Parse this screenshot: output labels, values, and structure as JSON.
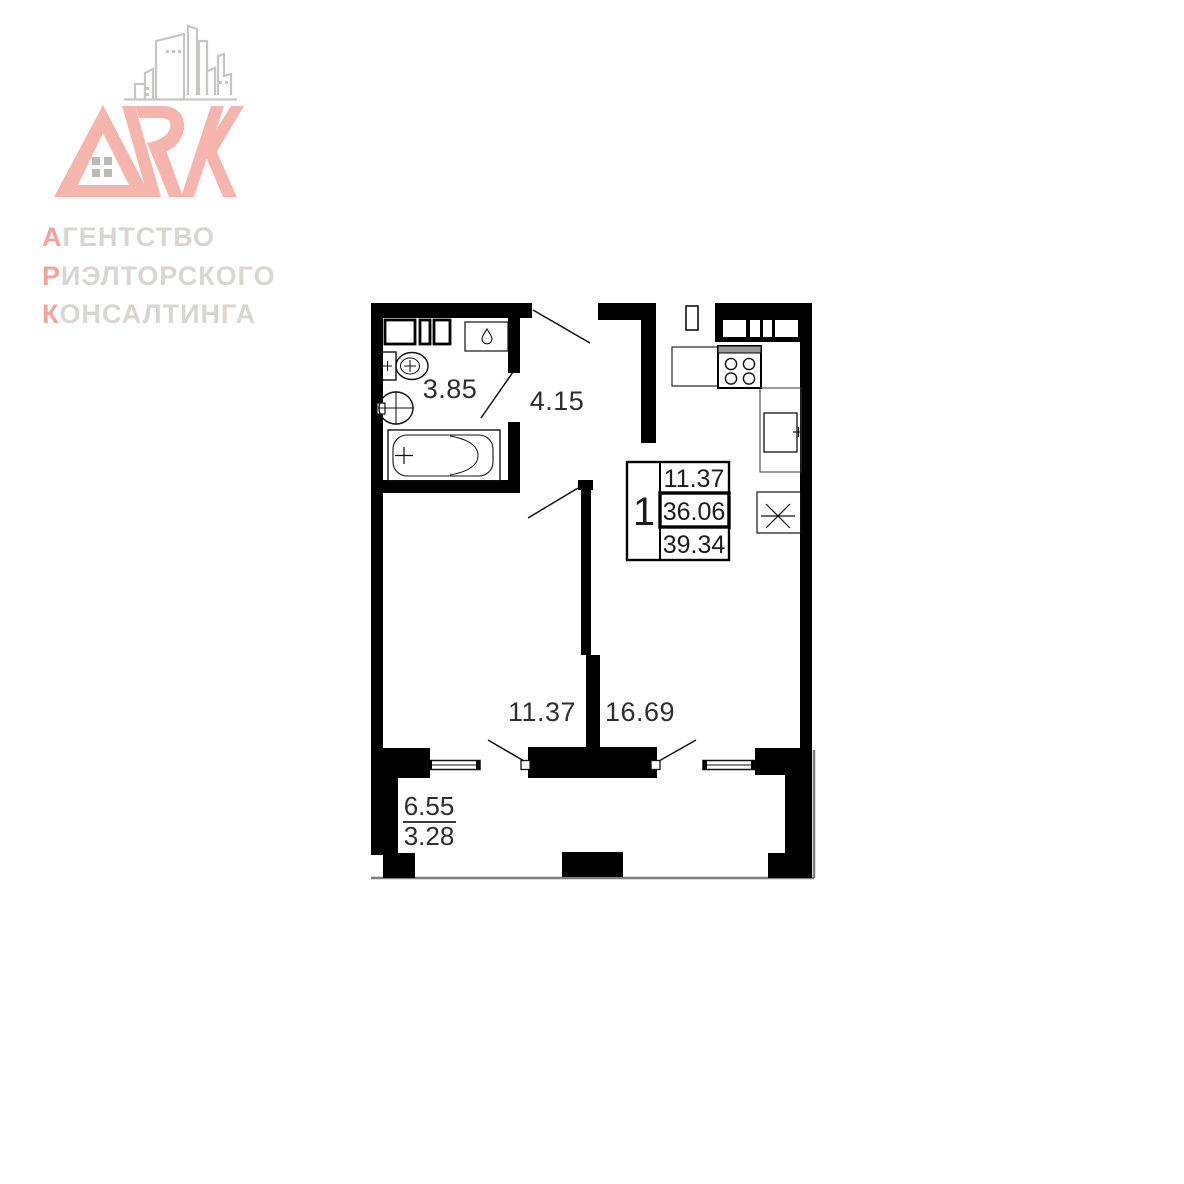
{
  "logo": {
    "monogram": "ARK",
    "lines": [
      {
        "first": "А",
        "rest": "ГЕНТСТВО"
      },
      {
        "first": "Р",
        "rest": "ИЭЛТОРСКОГО"
      },
      {
        "first": "К",
        "rest": "ОНСАЛТИНГА"
      }
    ],
    "accent_color": "#f0a49b",
    "letters_color": "#f5b5ad",
    "gray_text_color": "#d8d5d3",
    "buildings_line_color": "#c8c6c5"
  },
  "plan": {
    "wall_color": "#000000",
    "outline_gray": "#7d7d7d",
    "rooms": [
      {
        "name": "bathroom",
        "area": "3.85"
      },
      {
        "name": "hallway",
        "area": "4.15"
      },
      {
        "name": "room",
        "area": "11.37"
      },
      {
        "name": "kitchen-living-room",
        "area": "16.69"
      }
    ],
    "balcony": {
      "total_area": "6.55",
      "reduced_area": "3.28"
    },
    "info_table": {
      "rooms_count": "1",
      "living_area": "11.37",
      "area_without_balcony": "36.06",
      "total_area": "39.34"
    },
    "fixtures": [
      "bathtub",
      "toilet",
      "washbasin",
      "water-heater",
      "cabinets",
      "stove",
      "kitchen-counter",
      "kitchen-sink",
      "appliance-x"
    ]
  }
}
